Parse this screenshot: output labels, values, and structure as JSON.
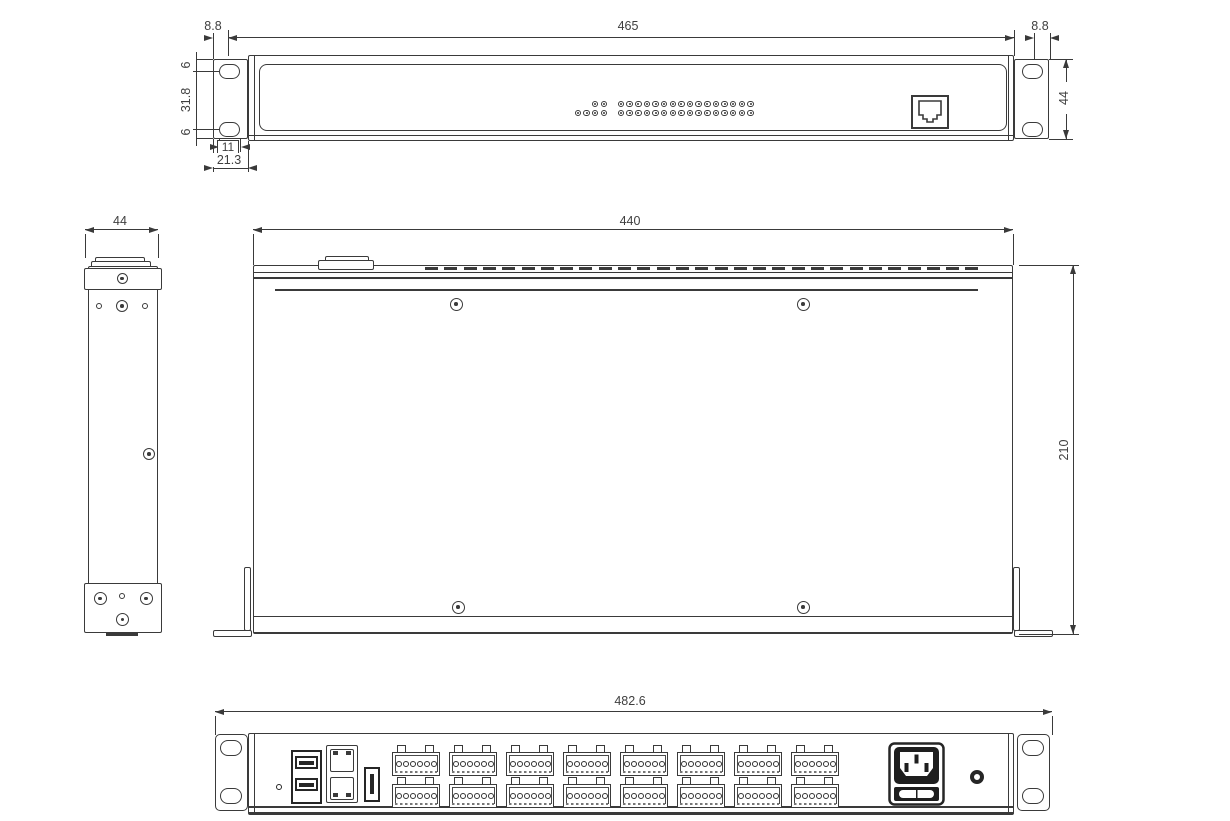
{
  "meta": {
    "doc_type": "rack-unit-mechanical-drawing",
    "units": "mm",
    "line_color": "#3a3a3a",
    "text_color": "#3f3f3f",
    "background": "#ffffff"
  },
  "front_view": {
    "dims": {
      "left_ear_hole_offset": "8.8",
      "panel_width": "465",
      "right_ear_hole_offset": "8.8",
      "panel_height": "44",
      "ear_hole_top_offset": "6",
      "ear_hole_span": "31.8",
      "ear_hole_bottom_offset": "6",
      "ear_hole_width": "11",
      "ear_width": "21.3"
    },
    "indicator_leds": {
      "left_group_row_counts": [
        2,
        4
      ],
      "matrix_rows": 2,
      "matrix_cols": 16
    },
    "ports": [
      "rj45"
    ]
  },
  "side_view": {
    "dims": {
      "width": "44"
    }
  },
  "top_view": {
    "dims": {
      "width": "440",
      "depth": "210"
    },
    "vent_slots": 29
  },
  "rear_view": {
    "dims": {
      "overall_width": "482.6"
    },
    "terminal_blocks": {
      "rows": 2,
      "per_row": 8,
      "pins_per_block": 6
    },
    "ports": [
      "dual-usb",
      "dual-rj45",
      "usb",
      "iec-c14-fused-inlet",
      "round-hole"
    ]
  }
}
